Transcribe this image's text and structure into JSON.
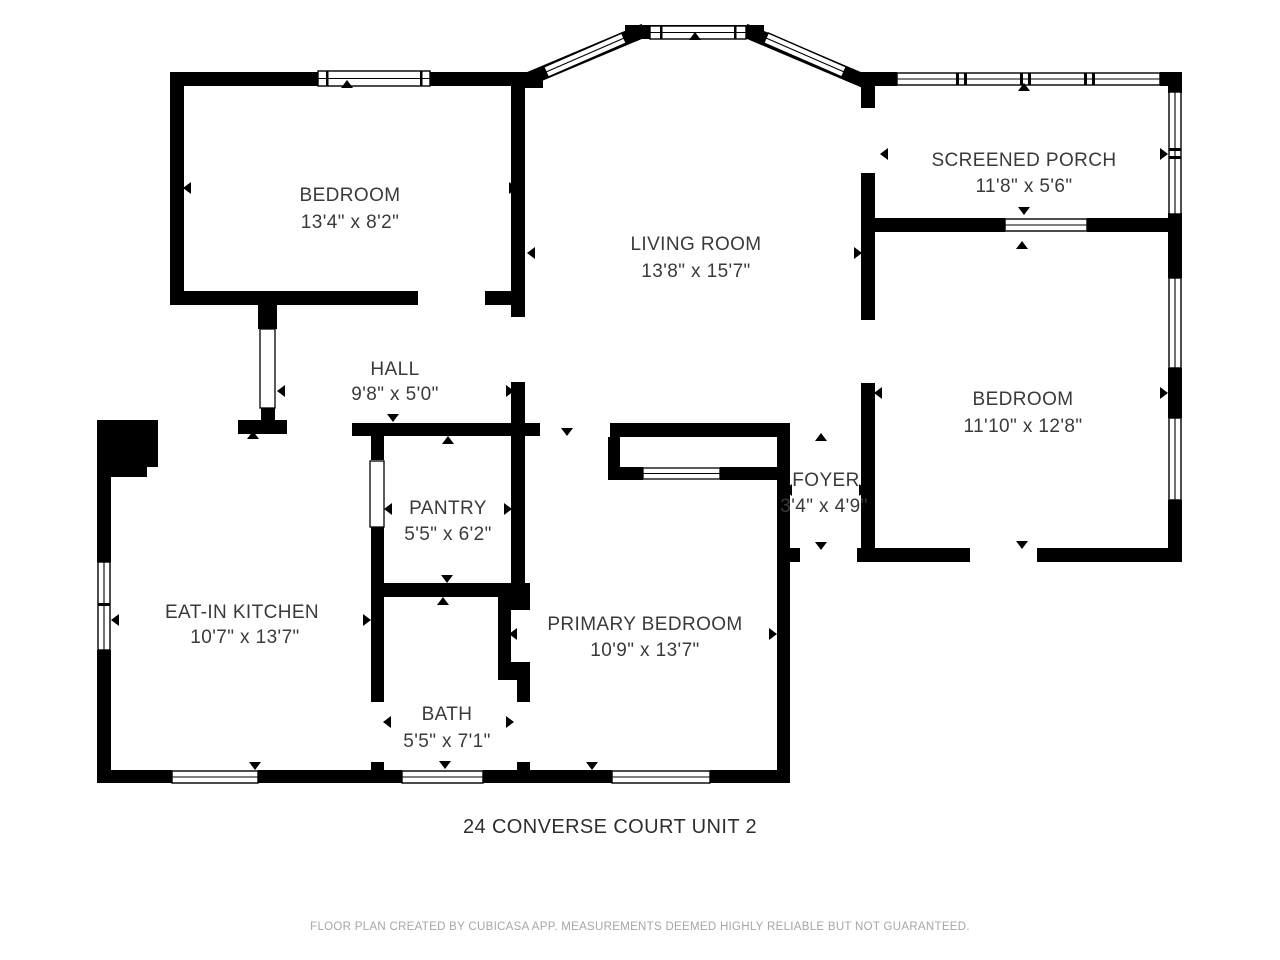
{
  "floorplan": {
    "title": "24 CONVERSE COURT UNIT 2",
    "footer": "FLOOR PLAN CREATED BY CUBICASA APP. MEASUREMENTS DEEMED HIGHLY RELIABLE BUT NOT GUARANTEED.",
    "colors": {
      "wall": "#000000",
      "room_text": "#3a3a3a",
      "title_text": "#2e2e2e",
      "footer_text": "#a6a6a6",
      "background": "#ffffff"
    },
    "rooms": [
      {
        "name": "BEDROOM",
        "dims": "13'4\" x 8'2\""
      },
      {
        "name": "LIVING ROOM",
        "dims": "13'8\" x 15'7\""
      },
      {
        "name": "SCREENED PORCH",
        "dims": "11'8\" x 5'6\""
      },
      {
        "name": "BEDROOM",
        "dims": "11'10\" x 12'8\""
      },
      {
        "name": "HALL",
        "dims": "9'8\" x 5'0\""
      },
      {
        "name": "PANTRY",
        "dims": "5'5\" x 6'2\""
      },
      {
        "name": "FOYER",
        "dims": "3'4\" x 4'9\""
      },
      {
        "name": "EAT-IN KITCHEN",
        "dims": "10'7\" x 13'7\""
      },
      {
        "name": "PRIMARY BEDROOM",
        "dims": "10'9\" x 13'7\""
      },
      {
        "name": "BATH",
        "dims": "5'5\" x 7'1\""
      }
    ]
  }
}
